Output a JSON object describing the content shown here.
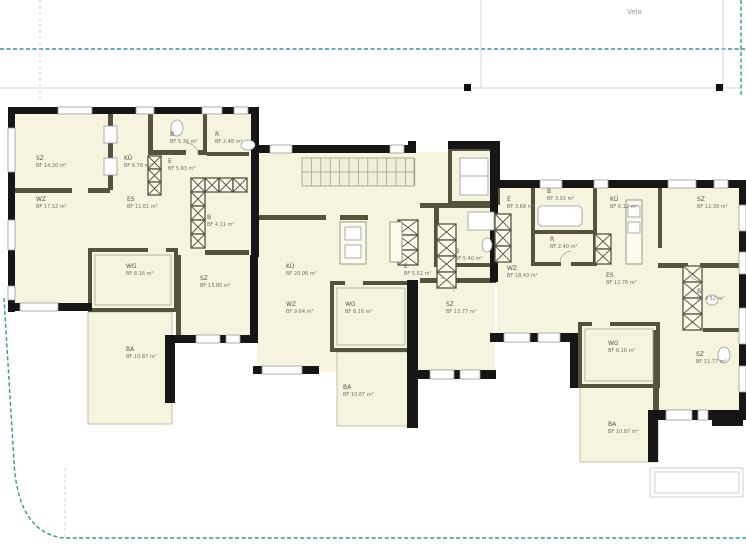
{
  "site": {
    "velo_label": "Velo"
  },
  "colors": {
    "boundary_teal": "#2f9c8c",
    "wall_black": "#161616",
    "wall_olive": "#56533c",
    "room_fill": "#f6f3de",
    "label_gray": "#63635a"
  },
  "units": [
    {
      "id": "unit-left",
      "rooms": [
        {
          "code": "SZ",
          "area": "BF 14.20 m²",
          "x": 36,
          "y": 155
        },
        {
          "code": "WZ",
          "area": "BF 17.52 m²",
          "x": 36,
          "y": 196
        },
        {
          "code": "KÜ",
          "area": "BF 6.78 m²",
          "x": 124,
          "y": 155
        },
        {
          "code": "B",
          "area": "BF 5.36 m²",
          "x": 170,
          "y": 131
        },
        {
          "code": "R",
          "area": "BF 2.48 m²",
          "x": 215,
          "y": 131
        },
        {
          "code": "E",
          "area": "BF 5.93 m²",
          "x": 168,
          "y": 158
        },
        {
          "code": "ES",
          "area": "BF 11.61 m²",
          "x": 127,
          "y": 196
        },
        {
          "code": "B",
          "area": "BF 4.11 m²",
          "x": 207,
          "y": 214
        },
        {
          "code": "WG",
          "area": "BF 8.16 m²",
          "x": 126,
          "y": 263
        },
        {
          "code": "SZ",
          "area": "BF 13.80 m²",
          "x": 200,
          "y": 275
        },
        {
          "code": "BA",
          "area": "BF 10.87 m²",
          "x": 126,
          "y": 346
        }
      ]
    },
    {
      "id": "unit-middle",
      "rooms": [
        {
          "code": "KÜ",
          "area": "BF 20.06 m²",
          "x": 286,
          "y": 263
        },
        {
          "code": "E",
          "area": "BF 5.52 m²",
          "x": 404,
          "y": 263
        },
        {
          "code": "B",
          "area": "BF 5.40 m²",
          "x": 455,
          "y": 248
        },
        {
          "code": "WZ",
          "area": "BF 9.64 m²",
          "x": 286,
          "y": 301
        },
        {
          "code": "WG",
          "area": "BF 8.16 m²",
          "x": 345,
          "y": 301
        },
        {
          "code": "SZ",
          "area": "BF 13.77 m²",
          "x": 446,
          "y": 301
        },
        {
          "code": "BA",
          "area": "BF 10.87 m²",
          "x": 343,
          "y": 384
        }
      ]
    },
    {
      "id": "unit-right",
      "rooms": [
        {
          "code": "E",
          "area": "BF 3.68 m²",
          "x": 507,
          "y": 196
        },
        {
          "code": "B",
          "area": "BF 3.91 m²",
          "x": 547,
          "y": 188
        },
        {
          "code": "KÜ",
          "area": "BF 6.12 m²",
          "x": 610,
          "y": 196
        },
        {
          "code": "SZ",
          "area": "BF 12.39 m²",
          "x": 697,
          "y": 196
        },
        {
          "code": "R",
          "area": "BF 2.40 m²",
          "x": 550,
          "y": 236
        },
        {
          "code": "WZ",
          "area": "BF 18.43 m²",
          "x": 507,
          "y": 265
        },
        {
          "code": "ES",
          "area": "BF 12.76 m²",
          "x": 606,
          "y": 272
        },
        {
          "code": "B",
          "area": "BF 4.52 m²",
          "x": 697,
          "y": 288
        },
        {
          "code": "WG",
          "area": "BF 8.16 m²",
          "x": 608,
          "y": 340
        },
        {
          "code": "SZ",
          "area": "BF 11.77 m²",
          "x": 696,
          "y": 351
        },
        {
          "code": "BA",
          "area": "BF 10.87 m²",
          "x": 608,
          "y": 421
        }
      ]
    }
  ]
}
